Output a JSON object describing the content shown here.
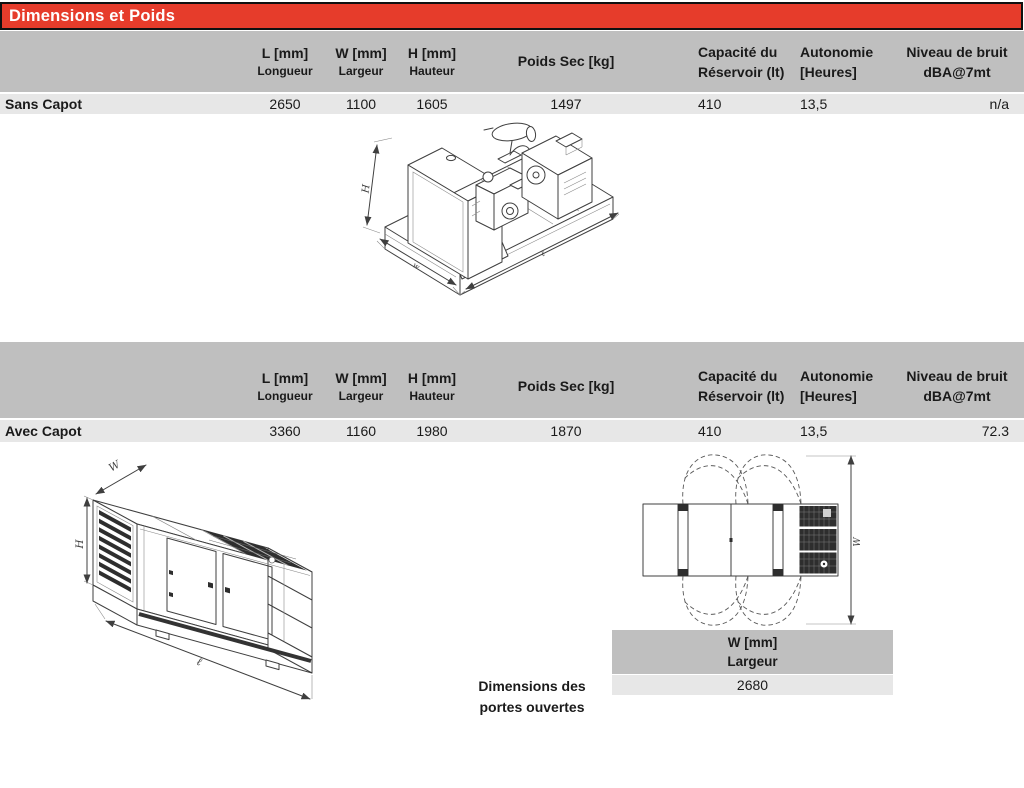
{
  "page": {
    "title": "Dimensions et Poids"
  },
  "columns": {
    "l": {
      "line1": "L [mm]",
      "line2": "Longueur"
    },
    "w": {
      "line1": "W [mm]",
      "line2": "Largeur"
    },
    "h": {
      "line1": "H  [mm]",
      "line2": "Hauteur"
    },
    "poids": {
      "line1": "Poids Sec [kg]"
    },
    "capacite": {
      "line1": "Capacité du",
      "line2": "Réservoir  (lt)"
    },
    "autonomie": {
      "line1": "Autonomie",
      "line2": "[Heures]"
    },
    "bruit": {
      "line1": "Niveau de bruit",
      "line2": "dBA@7mt"
    }
  },
  "rows": {
    "sans_capot": {
      "label": "Sans Capot",
      "l": "2650",
      "w": "1100",
      "h": "1605",
      "poids": "1497",
      "capacite": "410",
      "autonomie": "13,5",
      "bruit": "n/a"
    },
    "avec_capot": {
      "label": "Avec Capot",
      "l": "3360",
      "w": "1160",
      "h": "1980",
      "poids": "1870",
      "capacite": "410",
      "autonomie": "13,5",
      "bruit": "72.3"
    }
  },
  "doors_table": {
    "header_line1": "W [mm]",
    "header_line2": "Largeur",
    "value": "2680"
  },
  "doors_caption": {
    "line1": "Dimensions des",
    "line2": "portes ouvertes"
  },
  "drawings": {
    "open": {
      "h": "H",
      "w": "w",
      "l": "ℓ"
    },
    "canopy": {
      "h": "H",
      "w": "W",
      "l": "ℓ"
    },
    "top_view": {
      "w": "W"
    }
  },
  "colors": {
    "title_bg": "#e63c2b",
    "header_bg": "#bfbfbf",
    "row_bg": "#e7e7e7"
  }
}
